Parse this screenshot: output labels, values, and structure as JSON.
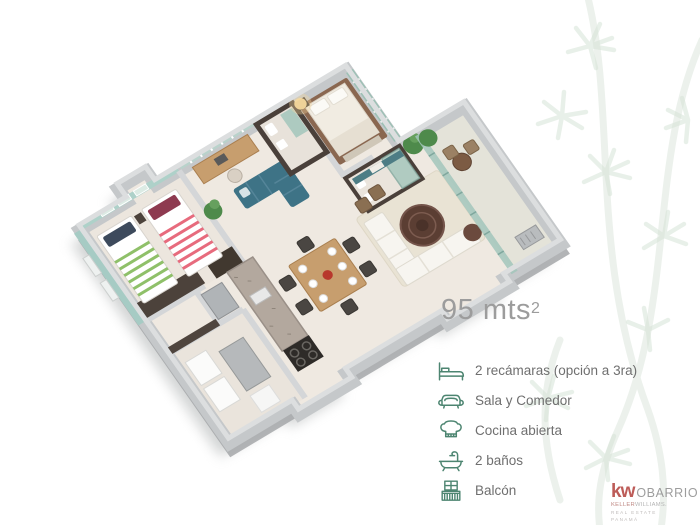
{
  "area": {
    "label": "95 mts",
    "superscript": "2"
  },
  "features": [
    {
      "icon": "bed-icon",
      "label": "2 recámaras (opción a 3ra)"
    },
    {
      "icon": "sofa-icon",
      "label": "Sala y Comedor"
    },
    {
      "icon": "chef-hat-icon",
      "label": "Cocina abierta"
    },
    {
      "icon": "bathtub-icon",
      "label": "2 baños"
    },
    {
      "icon": "balcony-icon",
      "label": "Balcón"
    }
  ],
  "logo": {
    "kw": "kw",
    "office": "OBARRIO",
    "line2a": "KELLER",
    "line2b": "WILLIAMS.",
    "line3": "REAL ESTATE",
    "line4": "PANAMÁ"
  },
  "palette": {
    "icon-green": "#4d8571",
    "feature-text": "#6f6f6f",
    "area-text": "#9c9c9c",
    "kw-red": "#b2403c",
    "logo-gray": "#8d8d8d",
    "leaf": "#dbe7dc",
    "mint-wall": "#aed1c9",
    "glass-teal": "#a2c6bb",
    "sofa-teal": "#3e7386",
    "wood": "#c79e6e",
    "dark-walnut": "#4c423b",
    "wall-gray": "#c5c8ca",
    "floor-beige": "#efe9e1"
  }
}
